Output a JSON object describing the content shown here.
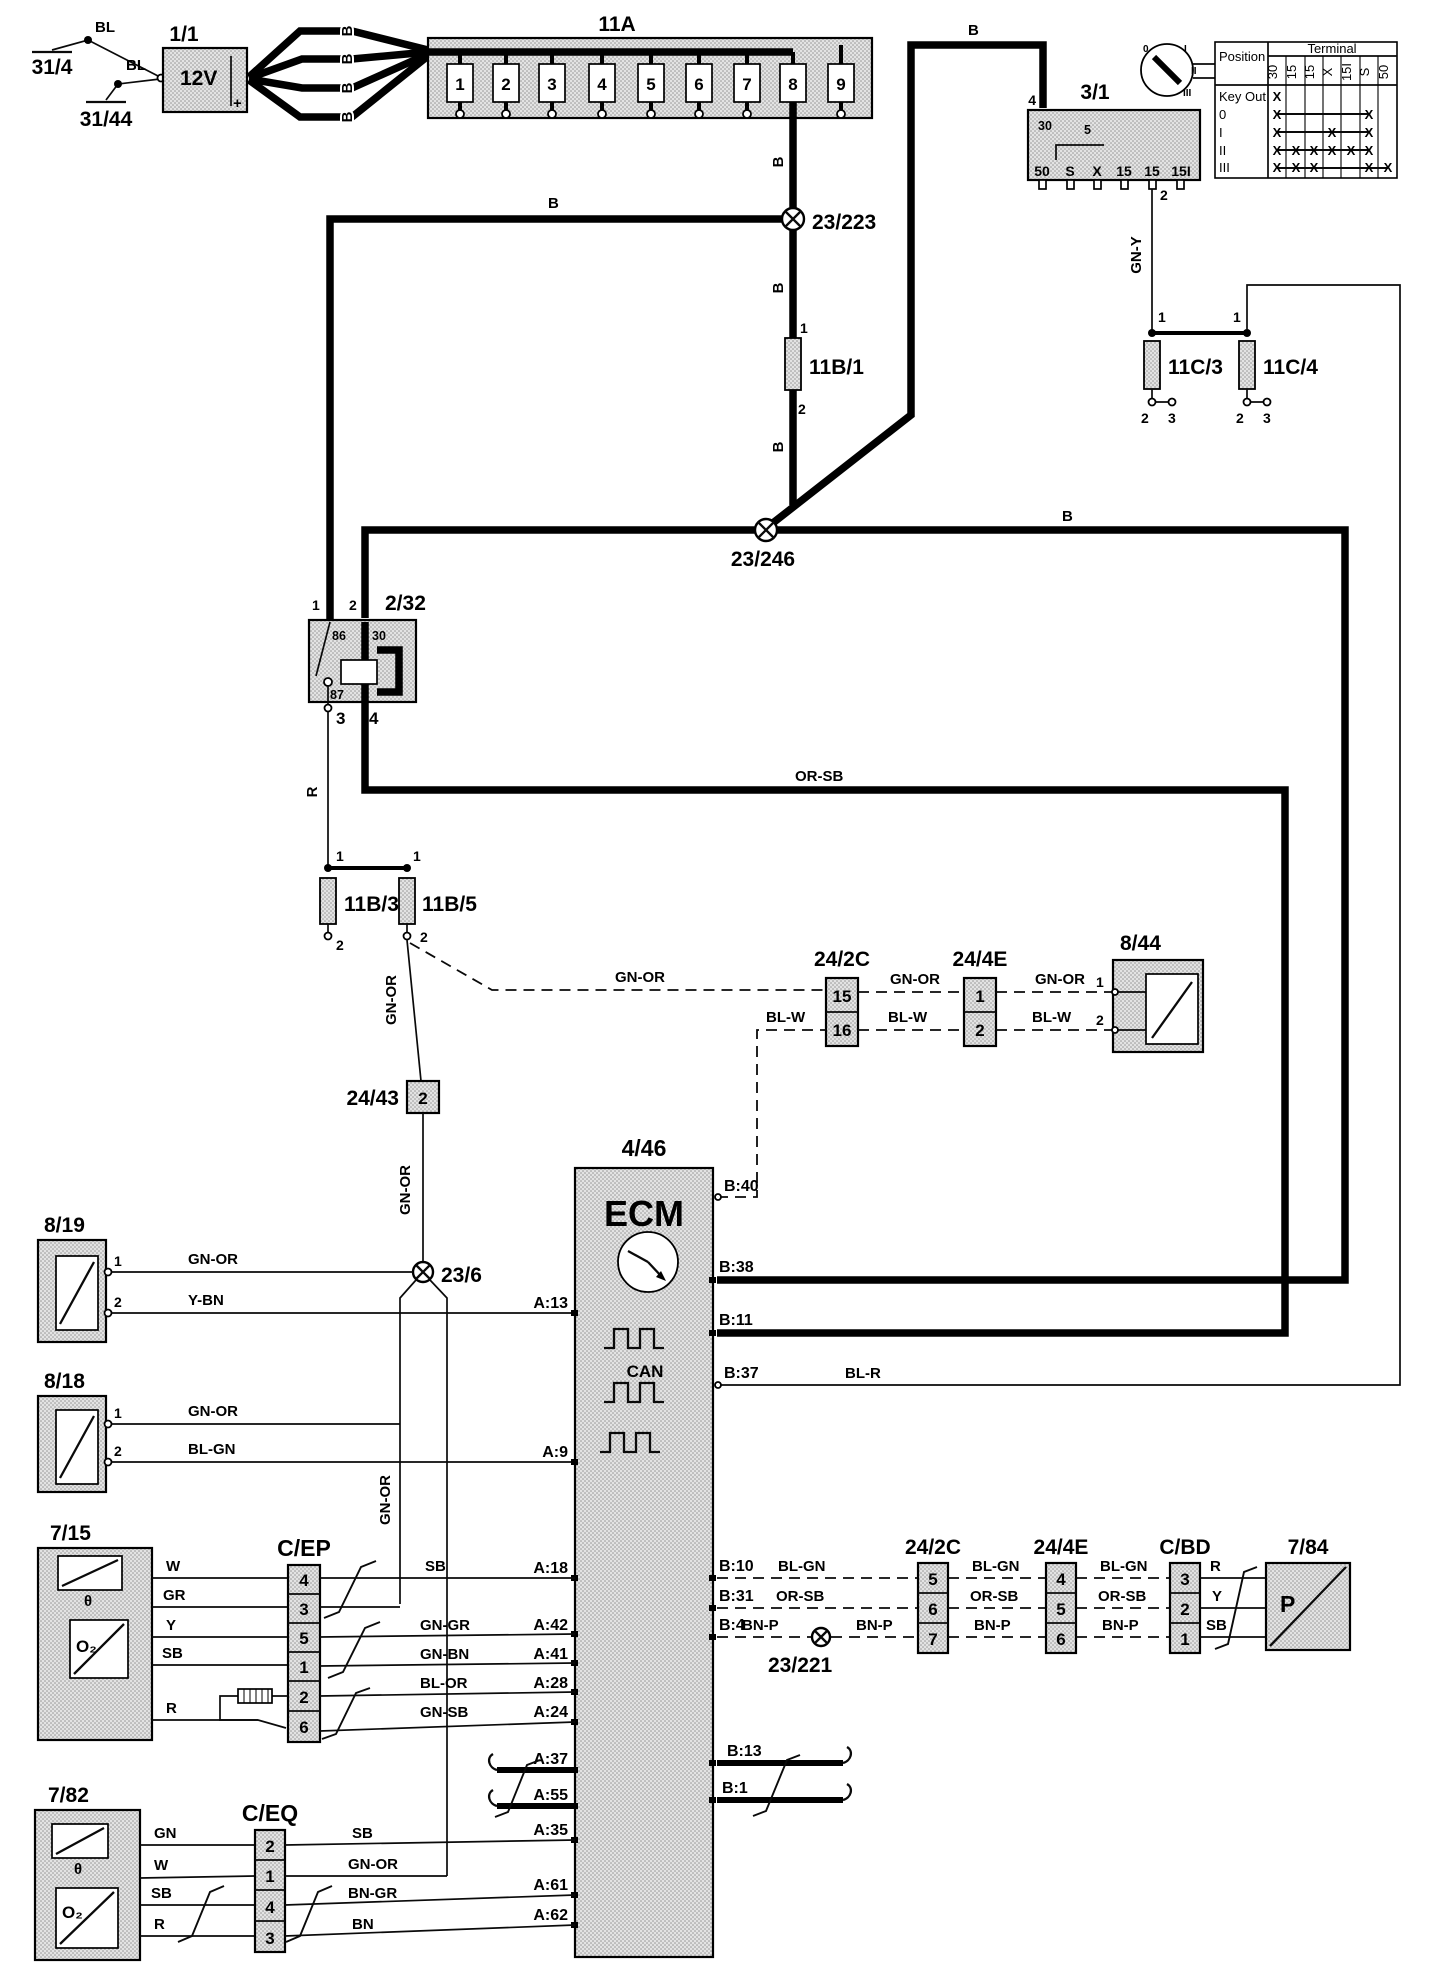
{
  "wires": {
    "b": "B",
    "bl": "BL",
    "r": "R",
    "gny": "GN-Y",
    "gnor": "GN-OR",
    "orsb": "OR-SB",
    "blw": "BL-W",
    "ybn": "Y-BN",
    "blgn": "BL-GN",
    "blr": "BL-R",
    "sb": "SB",
    "w": "W",
    "gr": "GR",
    "y": "Y",
    "gngr": "GN-GR",
    "gnbn": "GN-BN",
    "blor": "BL-OR",
    "gnsb": "GN-SB",
    "gn": "GN",
    "bngr": "BN-GR",
    "bn": "BN",
    "bnp": "BN-P"
  },
  "grounds": {
    "g1": "31/4",
    "g2": "31/44"
  },
  "battery": {
    "id": "1/1",
    "voltage": "12V",
    "plus": "+"
  },
  "fusebox": {
    "id": "11A",
    "fuses": [
      "1",
      "2",
      "3",
      "4",
      "5",
      "6",
      "7",
      "8",
      "9"
    ]
  },
  "ignition": {
    "id": "3/1",
    "pin_top": "4",
    "pin_bottom": "2",
    "t30": "30",
    "t5": "5",
    "terminals": [
      "50",
      "S",
      "X",
      "15",
      "15",
      "15I"
    ],
    "key_positions": [
      "0",
      "I",
      "II",
      "III"
    ]
  },
  "key_table": {
    "position": "Position",
    "terminal": "Terminal",
    "cols": [
      "30",
      "15",
      "15",
      "X",
      "15I",
      "S",
      "50"
    ],
    "rows": [
      {
        "label": "Key Out",
        "marks": [
          "X",
          "",
          "",
          "",
          "",
          "",
          ""
        ]
      },
      {
        "label": "0",
        "marks": [
          "X",
          "",
          "",
          "",
          "",
          "X",
          ""
        ]
      },
      {
        "label": "I",
        "marks": [
          "X",
          "",
          "",
          "X",
          "",
          "X",
          ""
        ]
      },
      {
        "label": "II",
        "marks": [
          "X",
          "X",
          "X",
          "X",
          "X",
          "X",
          ""
        ]
      },
      {
        "label": "III",
        "marks": [
          "X",
          "X",
          "X",
          "",
          "",
          "X",
          "X"
        ]
      }
    ]
  },
  "splices": {
    "s223": "23/223",
    "s246": "23/246",
    "s6": "23/6",
    "s221": "23/221"
  },
  "fuse11b1": {
    "id": "11B/1",
    "p1": "1",
    "p2": "2"
  },
  "fuse11b3": {
    "id": "11B/3",
    "p1": "1",
    "p2": "2"
  },
  "fuse11b5": {
    "id": "11B/5",
    "p1": "1",
    "p2": "2"
  },
  "fuse11c3": {
    "id": "11C/3",
    "p1": "1",
    "p2": "2",
    "p3": "3"
  },
  "fuse11c4": {
    "id": "11C/4",
    "p1": "1",
    "p2": "2",
    "p3": "3"
  },
  "relay": {
    "id": "2/32",
    "p1": "1",
    "p2": "2",
    "p3": "3",
    "p4": "4",
    "i86": "86",
    "i30": "30",
    "i87": "87",
    "i85": "85"
  },
  "c242c_top": {
    "id": "24/2C",
    "p15": "15",
    "p16": "16"
  },
  "c244e_top": {
    "id": "24/4E",
    "p1": "1",
    "p2": "2"
  },
  "sw844": {
    "id": "8/44",
    "p1": "1",
    "p2": "2"
  },
  "c2443": {
    "id": "24/43",
    "pin": "2"
  },
  "ecm": {
    "id": "4/46",
    "name": "ECM",
    "can": "CAN",
    "pins": {
      "a13": "A:13",
      "a9": "A:9",
      "a18": "A:18",
      "a42": "A:42",
      "a41": "A:41",
      "a28": "A:28",
      "a24": "A:24",
      "a37": "A:37",
      "a55": "A:55",
      "a35": "A:35",
      "a61": "A:61",
      "a62": "A:62",
      "b40": "B:40",
      "b38": "B:38",
      "b11": "B:11",
      "b37": "B:37",
      "b10": "B:10",
      "b31": "B:31",
      "b4": "B:4",
      "b13": "B:13",
      "b1": "B:1"
    }
  },
  "sw819": {
    "id": "8/19",
    "p1": "1",
    "p2": "2"
  },
  "sw818": {
    "id": "8/18",
    "p1": "1",
    "p2": "2"
  },
  "o2front": {
    "id": "7/15",
    "o2": "O₂",
    "theta": "θ"
  },
  "cep": {
    "id": "C/EP",
    "pins": [
      "4",
      "3",
      "5",
      "1",
      "2",
      "6"
    ]
  },
  "c242c_bot": {
    "id": "24/2C",
    "pins": [
      "5",
      "6",
      "7"
    ]
  },
  "c244e_bot": {
    "id": "24/4E",
    "pins": [
      "4",
      "5",
      "6"
    ]
  },
  "cbd": {
    "id": "C/BD",
    "pins": [
      "3",
      "2",
      "1"
    ]
  },
  "pump": {
    "id": "7/84",
    "label": "P"
  },
  "o2rear": {
    "id": "7/82",
    "o2": "O₂",
    "theta": "θ"
  },
  "ceq": {
    "id": "C/EQ",
    "pins": [
      "2",
      "1",
      "4",
      "3"
    ]
  }
}
